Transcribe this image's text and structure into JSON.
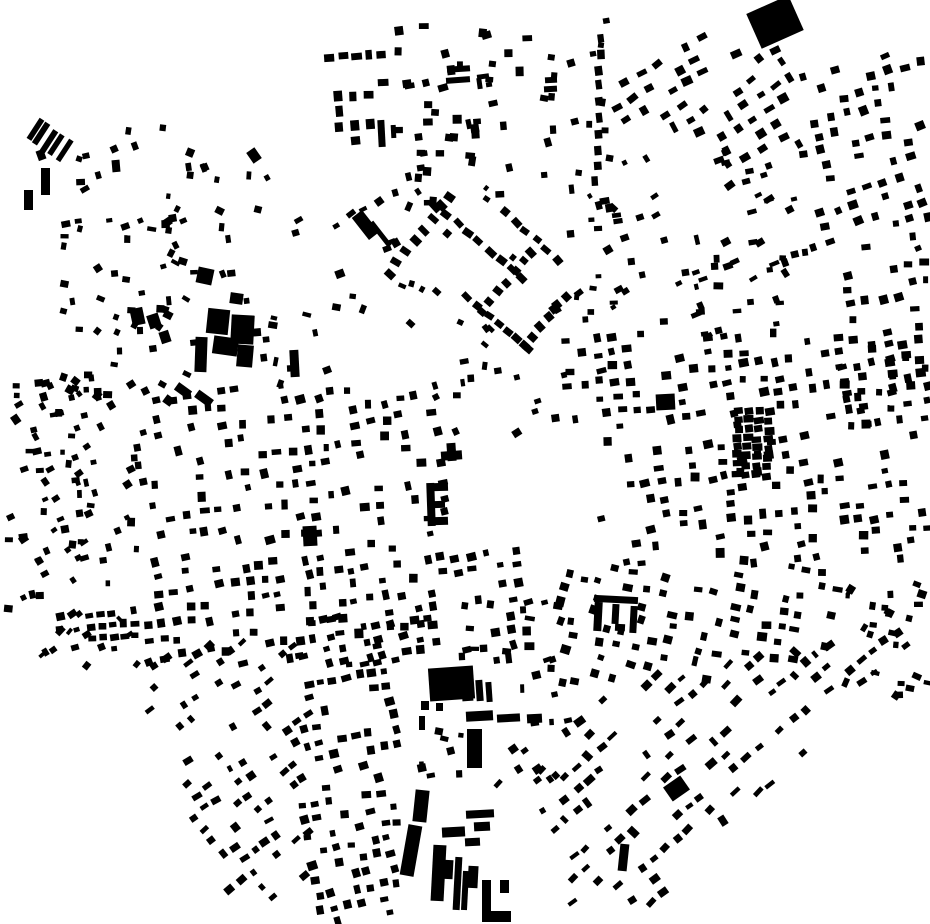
{
  "canvas": {
    "width": 930,
    "height": 924,
    "background": "#ffffff",
    "building_color": "#000000"
  },
  "map": {
    "kind": "figure-ground-building-footprints",
    "seed": 12345
  },
  "landmarks": [
    [
      37,
      150,
      8,
      10,
      -20
    ],
    [
      41,
      168,
      9,
      27,
      0
    ],
    [
      24,
      190,
      9,
      20,
      0
    ],
    [
      112,
      160,
      8,
      12,
      -5
    ],
    [
      249,
      149,
      10,
      13,
      -35
    ],
    [
      197,
      268,
      16,
      16,
      12
    ],
    [
      230,
      293,
      13,
      11,
      8
    ],
    [
      378,
      120,
      7,
      27,
      -3
    ],
    [
      391,
      125,
      5,
      13,
      -3
    ],
    [
      447,
      66,
      23,
      6,
      -4
    ],
    [
      446,
      77,
      24,
      6,
      -4
    ],
    [
      477,
      74,
      12,
      5,
      -8
    ],
    [
      477,
      78,
      5,
      11,
      -8
    ],
    [
      486,
      82,
      6,
      5,
      -8
    ],
    [
      545,
      77,
      12,
      6,
      -3
    ],
    [
      544,
      86,
      13,
      6,
      -3
    ],
    [
      752,
      3,
      46,
      38,
      -24
    ],
    [
      359,
      211,
      13,
      28,
      -38
    ],
    [
      378,
      219,
      5,
      30,
      -38
    ],
    [
      131,
      308,
      13,
      17,
      -12
    ],
    [
      148,
      314,
      12,
      14,
      -18
    ],
    [
      160,
      331,
      10,
      12,
      -18
    ],
    [
      207,
      309,
      22,
      25,
      6
    ],
    [
      231,
      315,
      23,
      29,
      3
    ],
    [
      213,
      337,
      25,
      18,
      8
    ],
    [
      195,
      337,
      12,
      35,
      2
    ],
    [
      237,
      345,
      16,
      22,
      5
    ],
    [
      175,
      386,
      16,
      9,
      36
    ],
    [
      195,
      394,
      18,
      9,
      36
    ],
    [
      164,
      396,
      9,
      9,
      36
    ],
    [
      290,
      350,
      9,
      27,
      -3
    ],
    [
      441,
      451,
      21,
      9,
      -4
    ],
    [
      447,
      443,
      9,
      18,
      -4
    ],
    [
      427,
      483,
      8,
      43,
      -2
    ],
    [
      431,
      483,
      17,
      8,
      -2
    ],
    [
      431,
      501,
      14,
      7,
      -2
    ],
    [
      431,
      517,
      17,
      8,
      -2
    ],
    [
      303,
      526,
      14,
      20,
      -3
    ],
    [
      656,
      394,
      19,
      16,
      -3
    ],
    [
      594,
      596,
      44,
      7,
      3
    ],
    [
      594,
      602,
      8,
      29,
      3
    ],
    [
      612,
      604,
      7,
      20,
      3
    ],
    [
      630,
      606,
      7,
      27,
      3
    ],
    [
      615,
      624,
      10,
      7,
      3
    ],
    [
      666,
      780,
      21,
      17,
      -35
    ],
    [
      619,
      844,
      9,
      27,
      6
    ],
    [
      429,
      667,
      45,
      33,
      -4
    ],
    [
      462,
      688,
      11,
      13,
      -4
    ],
    [
      476,
      680,
      7,
      21,
      -4
    ],
    [
      486,
      682,
      6,
      20,
      -4
    ],
    [
      466,
      711,
      27,
      10,
      -3
    ],
    [
      497,
      714,
      23,
      8,
      -3
    ],
    [
      527,
      714,
      15,
      9,
      -3
    ],
    [
      467,
      729,
      15,
      39,
      0
    ],
    [
      421,
      701,
      8,
      9,
      0
    ],
    [
      436,
      703,
      7,
      8,
      0
    ],
    [
      419,
      716,
      6,
      14,
      0
    ],
    [
      414,
      790,
      14,
      32,
      6
    ],
    [
      404,
      825,
      14,
      51,
      10
    ],
    [
      432,
      845,
      13,
      56,
      3
    ],
    [
      443,
      860,
      10,
      19,
      3
    ],
    [
      454,
      857,
      7,
      53,
      3
    ],
    [
      462,
      871,
      6,
      39,
      3
    ],
    [
      468,
      866,
      10,
      22,
      3
    ],
    [
      482,
      880,
      9,
      42,
      0
    ],
    [
      482,
      911,
      29,
      11,
      0
    ],
    [
      500,
      880,
      9,
      13,
      0
    ],
    [
      466,
      810,
      28,
      8,
      -3
    ],
    [
      474,
      822,
      16,
      9,
      -3
    ],
    [
      465,
      838,
      15,
      8,
      -3
    ],
    [
      442,
      827,
      23,
      10,
      -3
    ]
  ],
  "clusters": [
    {
      "kind": "chain",
      "x": 34,
      "y": 130,
      "dir": 33,
      "n": 5,
      "step": 9,
      "w": 24,
      "h": 5,
      "a": -57,
      "ja": 0
    },
    {
      "kind": "scatter",
      "box": [
        75,
        120,
        225,
        230
      ],
      "n": 20,
      "w": 7,
      "h": 6,
      "a": 0,
      "ja": 30
    },
    {
      "kind": "scatter",
      "box": [
        165,
        155,
        305,
        305
      ],
      "n": 16,
      "w": 7,
      "h": 6,
      "a": 0,
      "ja": 30
    },
    {
      "kind": "scatter",
      "box": [
        50,
        215,
        185,
        315
      ],
      "n": 22,
      "w": 7,
      "h": 6,
      "a": -10,
      "ja": 25
    },
    {
      "kind": "grid",
      "box": [
        326,
        40,
        392,
        86
      ],
      "sx": 13,
      "sy": 29,
      "w": 10,
      "h": 7,
      "a": -4,
      "d": 1,
      "jp": 1,
      "js": 1,
      "ja": 3
    },
    {
      "kind": "grid",
      "box": [
        325,
        85,
        373,
        143
      ],
      "sx": 16,
      "sy": 15,
      "w": 8,
      "h": 10,
      "a": -3,
      "d": 0.92,
      "jp": 1,
      "js": 1,
      "ja": 3
    },
    {
      "kind": "scatter",
      "box": [
        395,
        20,
        612,
        210
      ],
      "n": 62,
      "w": 8,
      "h": 7,
      "a": -3,
      "ja": 14
    },
    {
      "kind": "grid",
      "box": [
        408,
        126,
        472,
        180
      ],
      "sx": 17,
      "sy": 16,
      "w": 8,
      "h": 7,
      "a": -3,
      "d": 0.7,
      "jp": 2,
      "js": 1,
      "ja": 6
    },
    {
      "kind": "grid",
      "box": [
        615,
        28,
        802,
        142
      ],
      "sx": 18,
      "sy": 16,
      "w": 9,
      "h": 7,
      "a": -32,
      "d": 0.6,
      "jp": 2,
      "js": 2,
      "ja": 8
    },
    {
      "kind": "grid",
      "box": [
        798,
        52,
        930,
        258
      ],
      "sx": 17,
      "sy": 15,
      "w": 8,
      "h": 7,
      "a": -15,
      "d": 0.58,
      "jp": 2,
      "js": 2,
      "ja": 10
    },
    {
      "kind": "grid",
      "box": [
        836,
        255,
        930,
        432
      ],
      "sx": 16,
      "sy": 15,
      "w": 8,
      "h": 7,
      "a": -8,
      "d": 0.58,
      "jp": 2,
      "js": 2,
      "ja": 10
    },
    {
      "kind": "scatter",
      "box": [
        610,
        142,
        662,
        330
      ],
      "n": 12,
      "w": 7,
      "h": 6,
      "a": -20,
      "ja": 15
    },
    {
      "kind": "scatter",
      "box": [
        660,
        238,
        806,
        336
      ],
      "n": 34,
      "w": 8,
      "h": 6,
      "a": -15,
      "ja": 18
    },
    {
      "kind": "scatter",
      "box": [
        718,
        142,
        806,
        244
      ],
      "n": 20,
      "w": 8,
      "h": 6,
      "a": -25,
      "ja": 15
    },
    {
      "kind": "chain",
      "x": 449,
      "y": 196,
      "dir": 128,
      "n": 8,
      "step": 14,
      "w": 10,
      "h": 7,
      "a": 38,
      "ja": 8
    },
    {
      "kind": "chain",
      "x": 436,
      "y": 206,
      "dir": 40,
      "n": 9,
      "step": 14,
      "w": 10,
      "h": 7,
      "a": 40,
      "ja": 8
    },
    {
      "kind": "chain",
      "x": 505,
      "y": 212,
      "dir": 42,
      "n": 6,
      "step": 14,
      "w": 9,
      "h": 7,
      "a": 42,
      "ja": 8
    },
    {
      "kind": "chain",
      "x": 532,
      "y": 252,
      "dir": 130,
      "n": 7,
      "step": 13,
      "w": 9,
      "h": 7,
      "a": 40,
      "ja": 8
    },
    {
      "kind": "chain",
      "x": 468,
      "y": 298,
      "dir": 40,
      "n": 7,
      "step": 13,
      "w": 9,
      "h": 7,
      "a": 40,
      "ja": 8
    },
    {
      "kind": "chain",
      "x": 566,
      "y": 296,
      "dir": 130,
      "n": 6,
      "step": 13,
      "w": 9,
      "h": 7,
      "a": 45,
      "ja": 8
    },
    {
      "kind": "scatter",
      "box": [
        398,
        178,
        632,
        345
      ],
      "n": 20,
      "w": 7,
      "h": 6,
      "a": 40,
      "ja": 20
    },
    {
      "kind": "scatter",
      "box": [
        430,
        345,
        565,
        448
      ],
      "n": 14,
      "w": 7,
      "h": 6,
      "a": -10,
      "ja": 25
    },
    {
      "kind": "scatter",
      "box": [
        58,
        298,
        200,
        400
      ],
      "n": 26,
      "w": 7,
      "h": 6,
      "a": 15,
      "ja": 25
    },
    {
      "kind": "scatter",
      "box": [
        252,
        298,
        332,
        402
      ],
      "n": 12,
      "w": 7,
      "h": 6,
      "a": 0,
      "ja": 25
    },
    {
      "kind": "scatter",
      "box": [
        8,
        382,
        150,
        665
      ],
      "n": 95,
      "w": 7,
      "h": 6,
      "a": -15,
      "ja": 22
    },
    {
      "kind": "grid",
      "box": [
        86,
        606,
        140,
        644
      ],
      "sx": 11,
      "sy": 12,
      "w": 8,
      "h": 6,
      "a": -5,
      "d": 0.9,
      "jp": 1,
      "js": 1,
      "ja": 5
    },
    {
      "kind": "grid",
      "box": [
        146,
        386,
        448,
        546
      ],
      "sx": 16,
      "sy": 17,
      "w": 8,
      "h": 7,
      "a": -8,
      "d": 0.58,
      "jp": 3,
      "js": 2,
      "ja": 8
    },
    {
      "kind": "grid",
      "box": [
        146,
        546,
        532,
        668
      ],
      "sx": 15,
      "sy": 16,
      "w": 8,
      "h": 7,
      "a": -7,
      "d": 0.6,
      "jp": 3,
      "js": 2,
      "ja": 8
    },
    {
      "kind": "grid",
      "box": [
        553,
        328,
        930,
        430
      ],
      "sx": 16,
      "sy": 15,
      "w": 8,
      "h": 7,
      "a": -7,
      "d": 0.55,
      "jp": 3,
      "js": 2,
      "ja": 8
    },
    {
      "kind": "grid",
      "box": [
        598,
        430,
        930,
        566
      ],
      "sx": 16,
      "sy": 15,
      "w": 8,
      "h": 7,
      "a": -7,
      "d": 0.55,
      "jp": 3,
      "js": 2,
      "ja": 8
    },
    {
      "kind": "chain",
      "x": 739,
      "y": 410,
      "dir": 93,
      "n": 8,
      "step": 9,
      "w": 9,
      "h": 7,
      "a": -5,
      "ja": 4
    },
    {
      "kind": "chain",
      "x": 749,
      "y": 411,
      "dir": 93,
      "n": 8,
      "step": 9,
      "w": 9,
      "h": 7,
      "a": -5,
      "ja": 4
    },
    {
      "kind": "chain",
      "x": 759,
      "y": 412,
      "dir": 93,
      "n": 8,
      "step": 9,
      "w": 9,
      "h": 7,
      "a": -5,
      "ja": 4
    },
    {
      "kind": "chain",
      "x": 769,
      "y": 413,
      "dir": 93,
      "n": 8,
      "step": 9,
      "w": 9,
      "h": 7,
      "a": -5,
      "ja": 4
    },
    {
      "kind": "grid",
      "box": [
        558,
        566,
        722,
        692
      ],
      "sx": 16,
      "sy": 15,
      "w": 8,
      "h": 7,
      "a": 12,
      "d": 0.52,
      "jp": 3,
      "js": 2,
      "ja": 8
    },
    {
      "kind": "grid",
      "box": [
        722,
        558,
        848,
        668
      ],
      "sx": 16,
      "sy": 15,
      "w": 8,
      "h": 7,
      "a": 8,
      "d": 0.5,
      "jp": 3,
      "js": 2,
      "ja": 8
    },
    {
      "kind": "scatter",
      "box": [
        845,
        558,
        930,
        705
      ],
      "n": 26,
      "w": 7,
      "h": 6,
      "a": 15,
      "ja": 20
    },
    {
      "kind": "grid",
      "box": [
        553,
        600,
        910,
        905
      ],
      "sx": 15,
      "sy": 17,
      "w": 9,
      "h": 6,
      "a": -40,
      "d": 0.5,
      "jp": 2,
      "js": 2,
      "ja": 8,
      "mask": [
        [
          553,
          700
        ],
        [
          900,
          614
        ],
        [
          908,
          648
        ],
        [
          655,
          905
        ],
        [
          553,
          905
        ]
      ]
    },
    {
      "kind": "grid",
      "box": [
        298,
        614,
        432,
        924
      ],
      "sx": 13,
      "sy": 15,
      "w": 8,
      "h": 7,
      "a": -10,
      "d": 0.55,
      "jp": 2,
      "js": 2,
      "ja": 8,
      "mask": [
        [
          298,
          614
        ],
        [
          432,
          614
        ],
        [
          432,
          660
        ],
        [
          397,
          660
        ],
        [
          397,
          924
        ],
        [
          298,
          924
        ]
      ]
    },
    {
      "kind": "grid",
      "box": [
        146,
        638,
        312,
        924
      ],
      "sx": 14,
      "sy": 16,
      "w": 8,
      "h": 6,
      "a": -36,
      "d": 0.55,
      "jp": 2,
      "js": 2,
      "ja": 8,
      "mask": [
        [
          146,
          638
        ],
        [
          312,
          638
        ],
        [
          312,
          924
        ],
        [
          237,
          924
        ],
        [
          146,
          706
        ]
      ]
    },
    {
      "kind": "scatter",
      "box": [
        28,
        610,
        145,
        668
      ],
      "n": 10,
      "w": 8,
      "h": 5,
      "a": -40,
      "ja": 12
    },
    {
      "kind": "scatter",
      "box": [
        430,
        598,
        560,
        660
      ],
      "n": 16,
      "w": 8,
      "h": 6,
      "a": -5,
      "ja": 15
    },
    {
      "kind": "scatter",
      "box": [
        495,
        652,
        568,
        728
      ],
      "n": 9,
      "w": 8,
      "h": 6,
      "a": -5,
      "ja": 15
    },
    {
      "kind": "scatter",
      "box": [
        420,
        700,
        462,
        790
      ],
      "n": 8,
      "w": 7,
      "h": 6,
      "a": 0,
      "ja": 15
    },
    {
      "kind": "chain",
      "x": 601,
      "y": 38,
      "dir": 92,
      "n": 10,
      "step": 16,
      "w": 7,
      "h": 9,
      "a": -4,
      "ja": 5
    },
    {
      "kind": "scatter",
      "box": [
        560,
        200,
        618,
        332
      ],
      "n": 10,
      "w": 7,
      "h": 6,
      "a": -10,
      "ja": 20
    },
    {
      "kind": "scatter",
      "box": [
        336,
        196,
        400,
        250
      ],
      "n": 8,
      "w": 7,
      "h": 6,
      "a": -30,
      "ja": 15
    },
    {
      "kind": "scatter",
      "box": [
        300,
        250,
        440,
        330
      ],
      "n": 6,
      "w": 7,
      "h": 6,
      "a": 0,
      "ja": 25
    },
    {
      "kind": "scatter",
      "box": [
        498,
        738,
        560,
        815
      ],
      "n": 10,
      "w": 7,
      "h": 6,
      "a": -40,
      "ja": 12
    }
  ]
}
